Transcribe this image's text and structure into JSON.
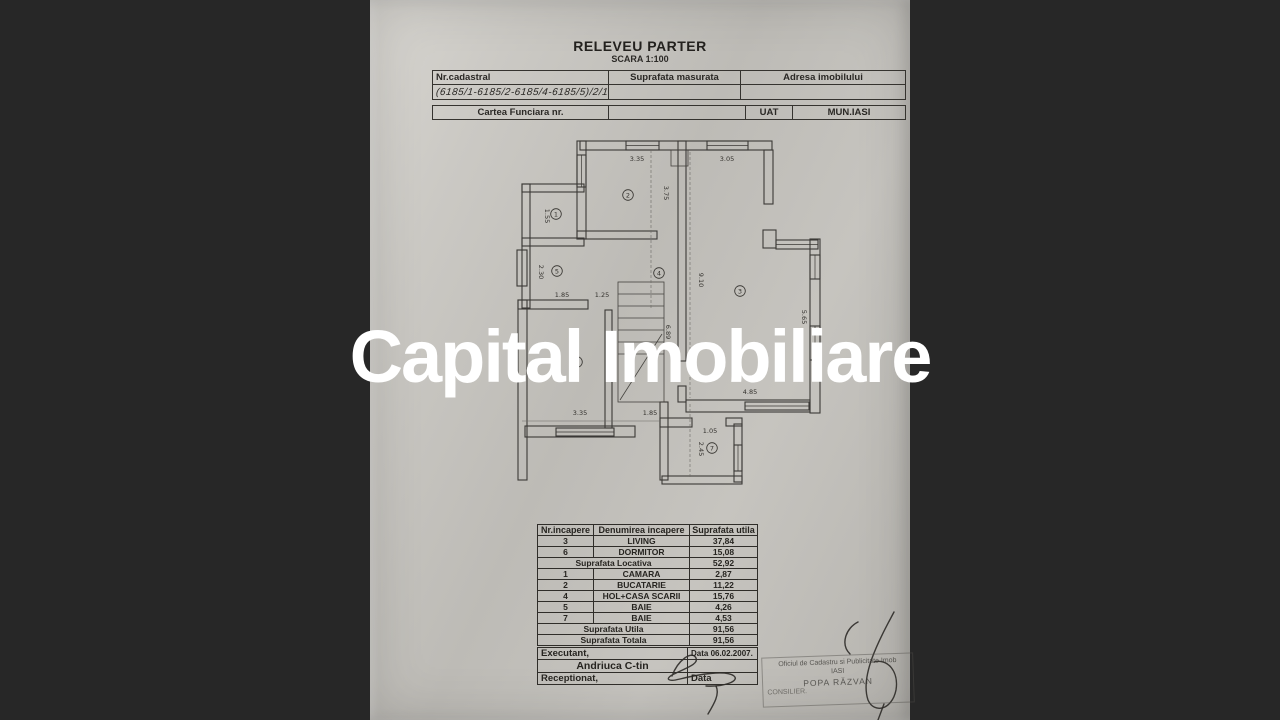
{
  "watermark": "Capital Imobiliare",
  "title": {
    "main": "RELEVEU PARTER",
    "scale": "SCARA 1:100"
  },
  "header_table": {
    "nr_cadastral_label": "Nr.cadastral",
    "suprafata_masurata_label": "Suprafata masurata",
    "adresa_label": "Adresa imobilului",
    "cadastral_value": "(6185/1-6185/2-6185/4-6185/5)/2/10",
    "cartea_funciara_label": "Cartea Funciara nr.",
    "uat_label": "UAT",
    "municipality": "MUN.IASI"
  },
  "plan": {
    "rooms": [
      {
        "n": "1",
        "x": 556,
        "y": 214
      },
      {
        "n": "2",
        "x": 628,
        "y": 195
      },
      {
        "n": "3",
        "x": 740,
        "y": 291
      },
      {
        "n": "4",
        "x": 659,
        "y": 273
      },
      {
        "n": "5",
        "x": 557,
        "y": 271
      },
      {
        "n": "6",
        "x": 577,
        "y": 362
      },
      {
        "n": "7",
        "x": 712,
        "y": 448
      }
    ],
    "dims": [
      {
        "t": "3.35",
        "x": 637,
        "y": 161,
        "r": 0
      },
      {
        "t": "3.05",
        "x": 727,
        "y": 161,
        "r": 0
      },
      {
        "t": "3.75",
        "x": 664,
        "y": 193,
        "r": 90
      },
      {
        "t": "1.55",
        "x": 545,
        "y": 216,
        "r": 90
      },
      {
        "t": "2.30",
        "x": 539,
        "y": 272,
        "r": 90
      },
      {
        "t": "1.85",
        "x": 562,
        "y": 297,
        "r": 0
      },
      {
        "t": "1.25",
        "x": 602,
        "y": 297,
        "r": 0
      },
      {
        "t": "9.10",
        "x": 699,
        "y": 280,
        "r": 90
      },
      {
        "t": "6.89",
        "x": 666,
        "y": 332,
        "r": 90
      },
      {
        "t": "5.65",
        "x": 802,
        "y": 317,
        "r": 90
      },
      {
        "t": "4.85",
        "x": 750,
        "y": 394,
        "r": 0
      },
      {
        "t": "3.35",
        "x": 580,
        "y": 415,
        "r": 0
      },
      {
        "t": "1.85",
        "x": 650,
        "y": 415,
        "r": 0
      },
      {
        "t": "1.05",
        "x": 710,
        "y": 433,
        "r": 0
      },
      {
        "t": "2.45",
        "x": 699,
        "y": 449,
        "r": 90
      }
    ]
  },
  "rooms_table": {
    "headers": [
      "Nr.incapere",
      "Denumirea incapere",
      "Suprafata utila"
    ],
    "rows": [
      {
        "n": "3",
        "name": "LIVING",
        "area": "37,84"
      },
      {
        "n": "6",
        "name": "DORMITOR",
        "area": "15,08"
      },
      {
        "merged": "Suprafata Locativa",
        "area": "52,92"
      },
      {
        "n": "1",
        "name": "CAMARA",
        "area": "2,87"
      },
      {
        "n": "2",
        "name": "BUCATARIE",
        "area": "11,22"
      },
      {
        "n": "4",
        "name": "HOL+CASA SCARII",
        "area": "15,76"
      },
      {
        "n": "5",
        "name": "BAIE",
        "area": "4,26"
      },
      {
        "n": "7",
        "name": "BAIE",
        "area": "4,53"
      },
      {
        "merged": "Suprafata Utila",
        "area": "91,56"
      },
      {
        "merged": "Suprafata Totala",
        "area": "91,56"
      }
    ]
  },
  "signature_block": {
    "executant_label": "Executant,",
    "executant_date": "Data  06.02.2007.",
    "executant_name": "Andriuca C-tin",
    "receptionat_label": "Receptionat,",
    "receptionat_date": "Data"
  },
  "stamp": {
    "line1": "Oficiul de Cadastru si Publicitate Imob",
    "line2": "IASI",
    "line3": "POPA RĂZVAN",
    "line4": "CONSILIER."
  },
  "colors": {
    "background": "#272727",
    "paper": "#c4c2bd",
    "ink": "#2f2d29",
    "watermark": "#ffffff"
  }
}
